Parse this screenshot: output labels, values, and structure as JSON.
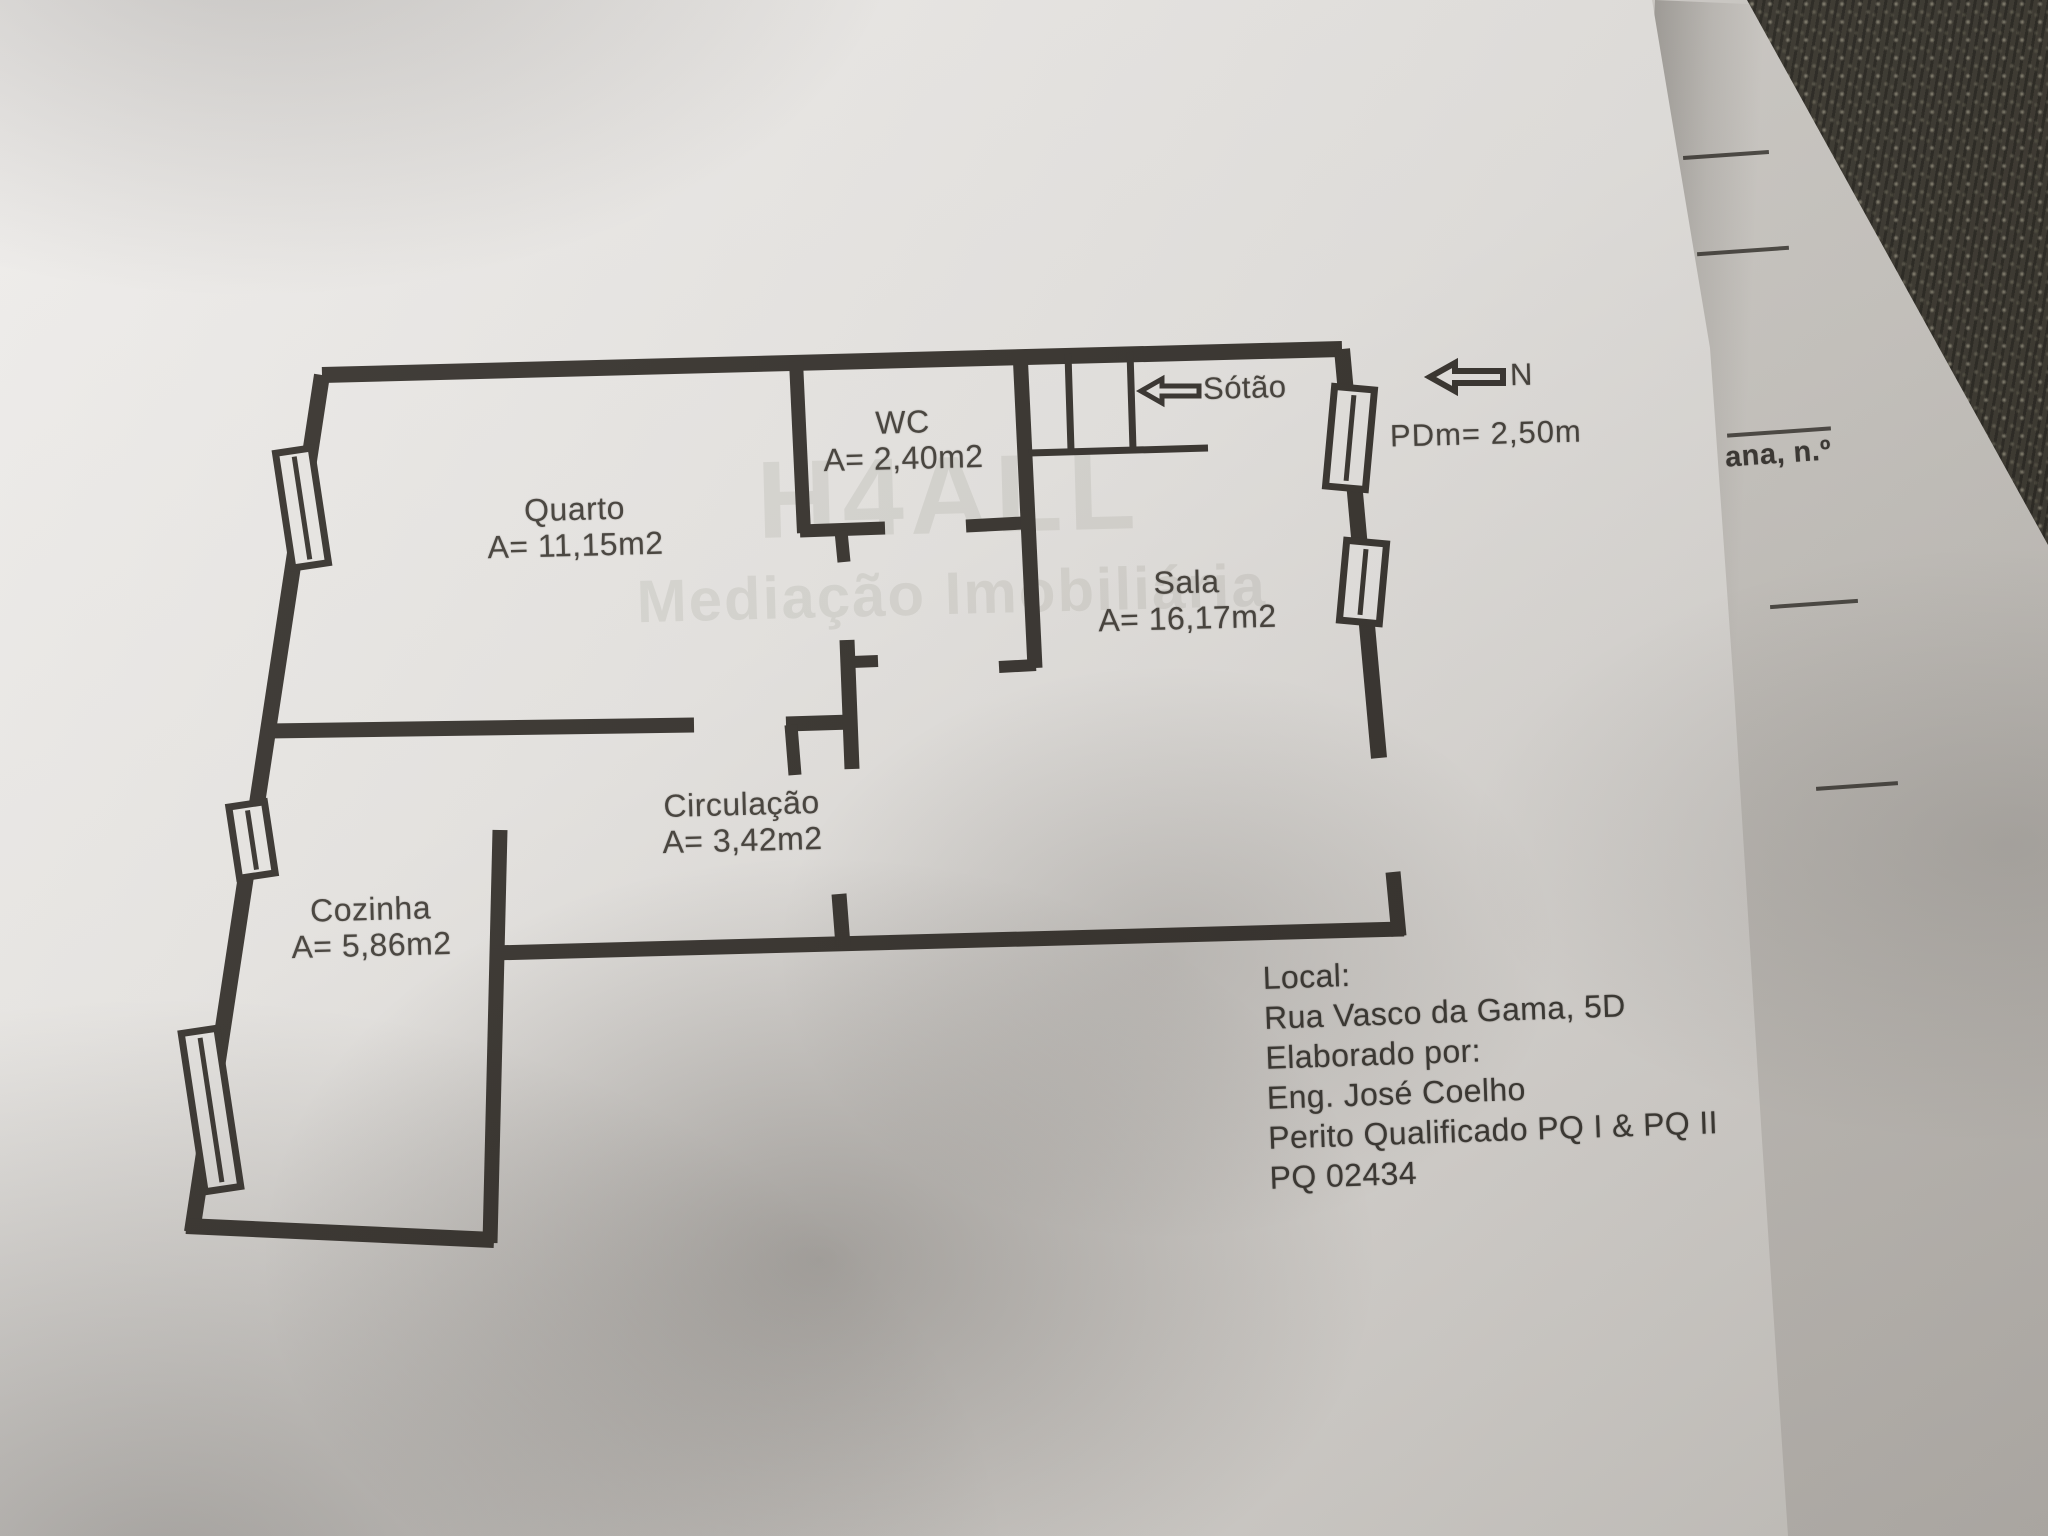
{
  "plan": {
    "rooms": [
      {
        "id": "quarto",
        "name": "Quarto",
        "area": "A= 11,15m2"
      },
      {
        "id": "wc",
        "name": "WC",
        "area": "A= 2,40m2"
      },
      {
        "id": "sala",
        "name": "Sala",
        "area": "A= 16,17m2"
      },
      {
        "id": "circulacao",
        "name": "Circulação",
        "area": "A= 3,42m2"
      },
      {
        "id": "cozinha",
        "name": "Cozinha",
        "area": "A= 5,86m2"
      }
    ],
    "annotations": {
      "sotao_label": "Sótão",
      "north_label": "N",
      "ceiling_height": "PDm= 2,50m"
    },
    "icons": [
      "attic-arrow-icon",
      "north-arrow-icon",
      "window-symbol",
      "stairs-icon"
    ]
  },
  "info_block": {
    "local_label": "Local:",
    "address": "Rua Vasco da Gama, 5D",
    "elaborado_label": "Elaborado por:",
    "author": "Eng. José Coelho",
    "qualification": "Perito Qualificado PQ I & PQ II",
    "license": "PQ 02434"
  },
  "background_sheet": {
    "partial_text": "ana, n.º"
  },
  "watermark": {
    "line1": "H4ALL",
    "line2": "Mediação Imobiliária"
  },
  "colors": {
    "wall_ink": "#38342f",
    "paper": "#e9e7e4",
    "under_paper": "#d2cfca",
    "fabric": "#3e3b33",
    "text_ink": "#45413b"
  }
}
